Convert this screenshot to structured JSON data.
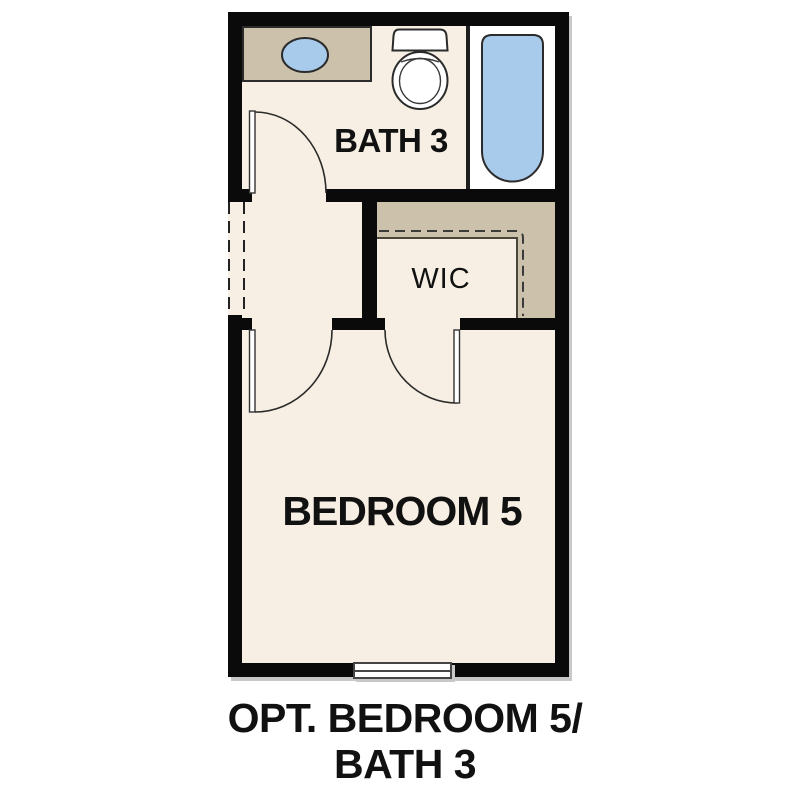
{
  "floorplan": {
    "rooms": {
      "bath": {
        "label": "BATH 3"
      },
      "wic": {
        "label": "WIC"
      },
      "bedroom": {
        "label": "BEDROOM 5"
      }
    },
    "fixtures": [
      "vanity-counter",
      "sink",
      "toilet",
      "bathtub",
      "closet-shelf",
      "closet-rod",
      "window",
      "door-swing",
      "wall-opening"
    ]
  },
  "caption": {
    "line1": "OPT. BEDROOM 5/",
    "line2": "BATH 3"
  },
  "colors": {
    "background": "#ffffff",
    "wall": "#0a0a0a",
    "floor": "#f7efe3",
    "millwork": "#ccc2ac",
    "fixture": "#a8caeb",
    "outline": "#2b2b2b",
    "alcove": "#ffffff",
    "shadow": "#c8c8c8",
    "text": "#111111"
  }
}
